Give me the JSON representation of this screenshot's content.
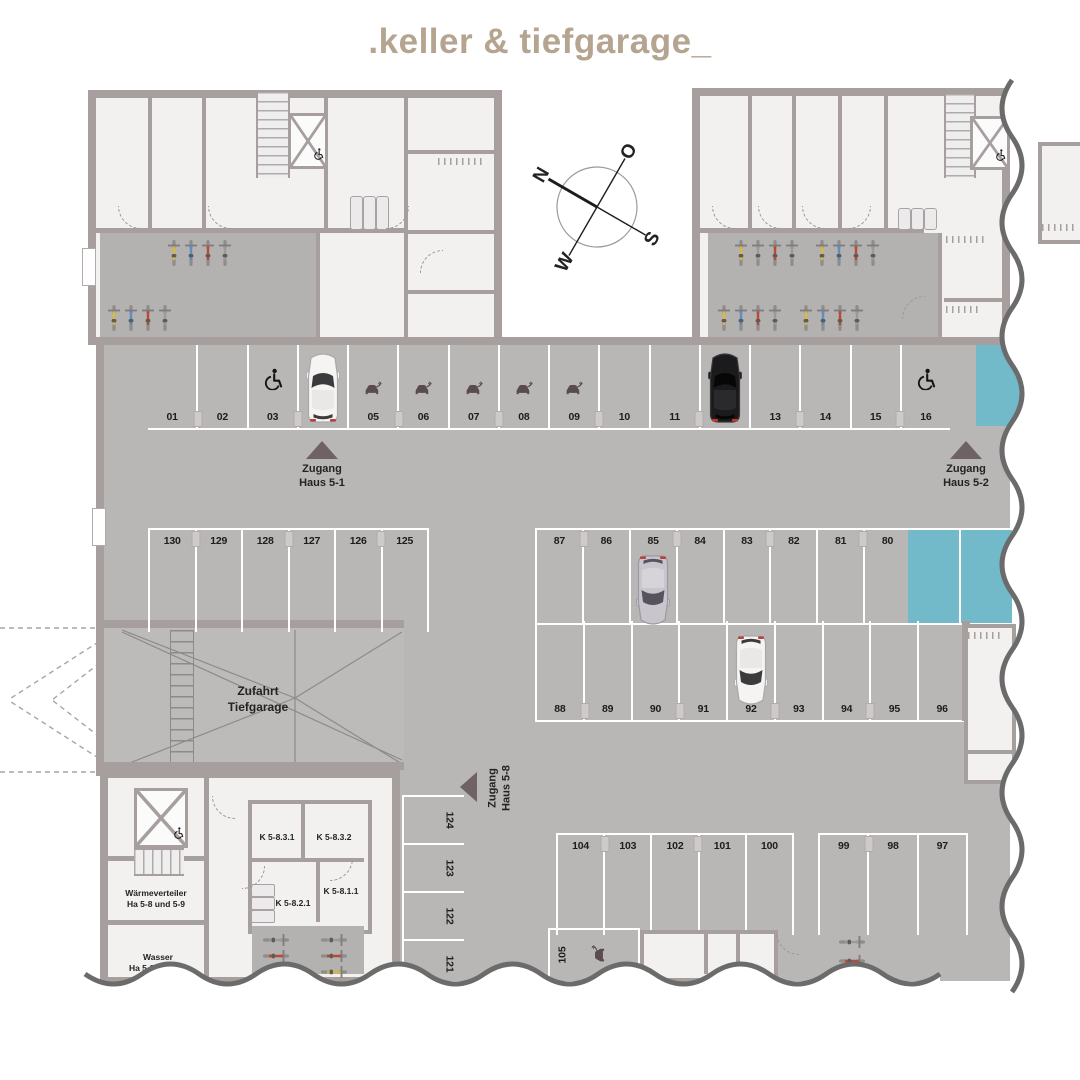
{
  "title": ".keller & tiefgarage_",
  "compass": {
    "n": "N",
    "e": "O",
    "s": "S",
    "w": "W"
  },
  "entrances": {
    "haus51": "Zugang\nHaus 5-1",
    "haus52": "Zugang\nHaus 5-2",
    "haus58": "Zugang\nHaus 5-8"
  },
  "rooms": {
    "ramp": "Zufahrt\nTiefgarage",
    "k831": "K 5-8.3.1",
    "k832": "K 5-8.3.2",
    "k811": "K 5-8.1.1",
    "k821": "K 5-8.2.1",
    "waerme": "Wärmeverteiler\nHa 5-8 und 5-9",
    "wasser": "Wasser\nHa 5-8 und 5-9"
  },
  "parking": {
    "rows": {
      "top": [
        {
          "n": "01"
        },
        {
          "n": "02"
        },
        {
          "n": "03",
          "icon": "wheelchair"
        },
        {
          "n": "04",
          "car": "white"
        },
        {
          "n": "05",
          "icon": "ev"
        },
        {
          "n": "06",
          "icon": "ev"
        },
        {
          "n": "07",
          "icon": "ev"
        },
        {
          "n": "08",
          "icon": "ev"
        },
        {
          "n": "09",
          "icon": "ev"
        },
        {
          "n": "10"
        },
        {
          "n": "11"
        },
        {
          "n": "12",
          "car": "black"
        },
        {
          "n": "13"
        },
        {
          "n": "14"
        },
        {
          "n": "15"
        },
        {
          "n": "16",
          "icon": "wheelchair"
        }
      ],
      "blue_top": [
        {
          "blue": true
        }
      ],
      "mid_left": [
        {
          "n": "130"
        },
        {
          "n": "129"
        },
        {
          "n": "128"
        },
        {
          "n": "127"
        },
        {
          "n": "126"
        },
        {
          "n": "125"
        }
      ],
      "mid_right_upper": [
        {
          "n": "87"
        },
        {
          "n": "86"
        },
        {
          "n": "85",
          "car": "silver",
          "car_dir": "down",
          "car_shift": 14
        },
        {
          "n": "84"
        },
        {
          "n": "83"
        },
        {
          "n": "82"
        },
        {
          "n": "81"
        },
        {
          "n": "80"
        }
      ],
      "blue_mid": [
        {
          "blue": true
        },
        {
          "blue": true
        }
      ],
      "mid_right_lower": [
        {
          "n": "88"
        },
        {
          "n": "89"
        },
        {
          "n": "90"
        },
        {
          "n": "91"
        },
        {
          "n": "92",
          "car": "white",
          "car_dir": "down"
        },
        {
          "n": "93"
        },
        {
          "n": "94"
        },
        {
          "n": "95"
        },
        {
          "n": "96"
        }
      ],
      "bottom_a": [
        {
          "n": "104"
        },
        {
          "n": "103"
        },
        {
          "n": "102"
        },
        {
          "n": "101"
        },
        {
          "n": "100"
        }
      ],
      "bottom_b": [
        {
          "n": "99"
        },
        {
          "n": "98"
        },
        {
          "n": "97"
        }
      ],
      "col_left": [
        {
          "n": "124"
        },
        {
          "n": "123"
        },
        {
          "n": "122"
        },
        {
          "n": "121"
        }
      ],
      "spot105": [
        {
          "n": "105",
          "icon": "ev"
        }
      ]
    }
  },
  "colors": {
    "reserved_blue": "#72bac9",
    "floor_gray": "#b9b6b6",
    "wall_gray": "#a79e9e",
    "title_tan": "#b5a490",
    "arrow_dark": "#6e6264",
    "bike_palette": {
      "yellow": "#d8b93c",
      "blue": "#5b8fc9",
      "red": "#c0472e",
      "gray": "#9a9a9a"
    }
  }
}
